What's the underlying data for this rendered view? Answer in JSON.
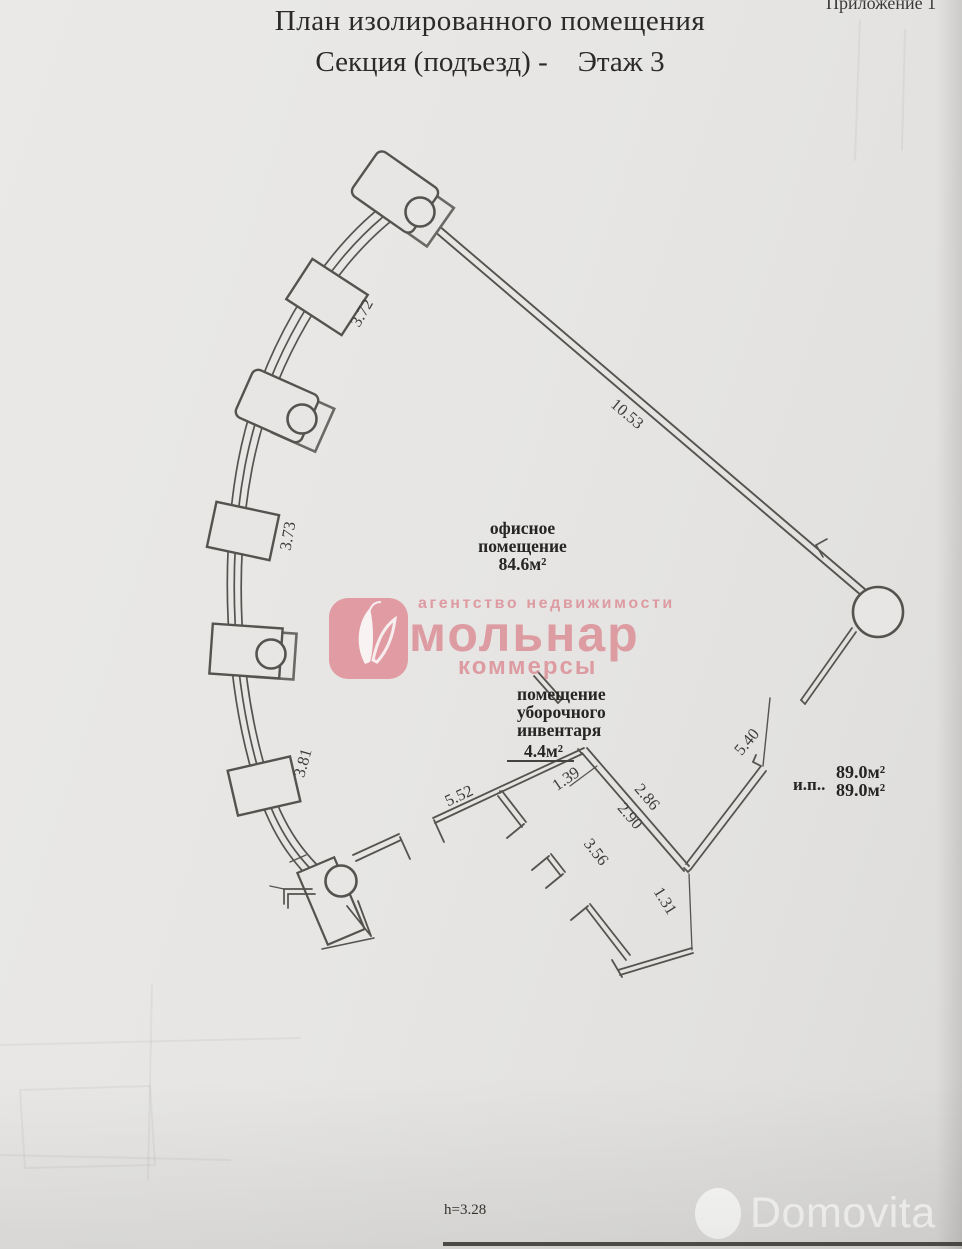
{
  "colors": {
    "paper": "#e7e6e4",
    "ink": "#55534f",
    "watermark_pink": "#dc8f97",
    "footer_line": "#3b3a37"
  },
  "header": {
    "title": "План изолированного помещения",
    "subtitle_section": "Секция (подъезд) -",
    "subtitle_floor": "Этаж 3",
    "appendix": "Приложение 1"
  },
  "plan": {
    "office_room": {
      "line1": "офисное",
      "line2": "помещение",
      "area": "84.6м²"
    },
    "cleaning_room": {
      "line1": "помещение",
      "line2": "уборочного",
      "line3": "инвентаря",
      "area": "4.4м²"
    },
    "isolated_premise": {
      "abbr": "и.п..",
      "area1": "89.0м²",
      "area2": "89.0м²"
    },
    "dimensions": {
      "d_3_72": "3.72",
      "d_3_73": "3.73",
      "d_3_81": "3.81",
      "d_10_53": "10.53",
      "d_5_52": "5.52",
      "d_1_39": "1.39",
      "d_2_86": "2.86",
      "d_2_90": "2.90",
      "d_3_56": "3.56",
      "d_5_40": "5.40",
      "d_1_31": "1.31"
    },
    "height_note": "h=3.28"
  },
  "watermark": {
    "tagline": "агентство недвижимости",
    "brand": "мольнар",
    "sub": "коммерсы"
  },
  "footer": {
    "brand": "Domovita"
  }
}
